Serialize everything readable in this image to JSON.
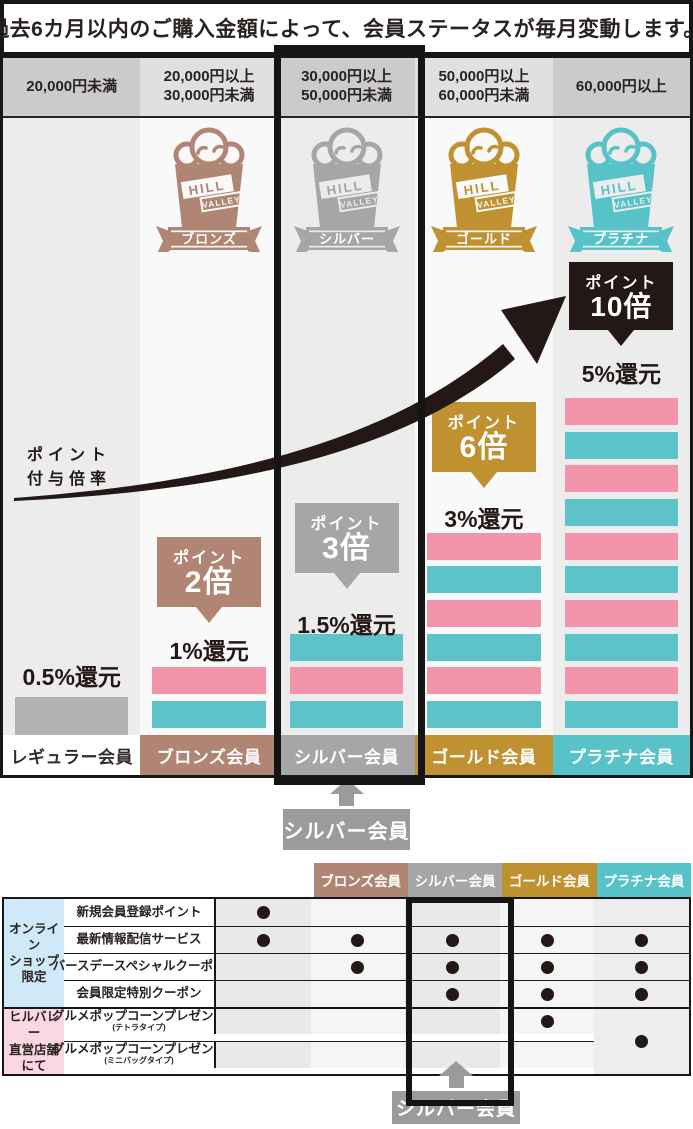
{
  "title": "過去6カ月以内のご購入金額によって、会員ステータスが毎月変動します。",
  "axis_label": {
    "line1": "ポイント",
    "line2": "付与倍率"
  },
  "brand": {
    "line1": "HILL",
    "line2": "VALLEY"
  },
  "pointer_callout": "シルバー会員",
  "colors": {
    "ink": "#231815",
    "frame": "#161616",
    "bronze": "#b08573",
    "silver": "#a6a6a8",
    "gold": "#bf9130",
    "platinum": "#57c3c8",
    "black_bubble": "#231815",
    "bar_pink": "#f295ab",
    "bar_teal": "#5cc3c8",
    "bar_gray": "#b1b1b1",
    "col_bg_dark": "#ececec",
    "col_bg_light": "#f9f9f9",
    "tier_bg_dark": "#cbcbcb",
    "tier_bg_light": "#e0e0e0",
    "pointer_gray": "#9b9b9b",
    "cat_blue": "#cfe9f8",
    "cat_pink": "#fbd7e2",
    "stripe_dark": "#e9e9e9",
    "stripe_light": "#f5f5f5"
  },
  "tiers": [
    {
      "id": "regular",
      "range_lines": [
        "20,000円未満"
      ],
      "badge_label": null,
      "bubble": null,
      "kangen": "0.5%還元",
      "bars": [
        "gray"
      ],
      "member_label": "レギュラー会員",
      "highlight": false
    },
    {
      "id": "bronze",
      "range_lines": [
        "20,000円以上",
        "30,000円未満"
      ],
      "badge_label": "ブロンズ",
      "bubble": {
        "prefix": "ポイント",
        "value": "2倍"
      },
      "kangen": "1%還元",
      "bars": [
        "pink",
        "teal"
      ],
      "member_label": "ブロンズ会員",
      "highlight": false
    },
    {
      "id": "silver",
      "range_lines": [
        "30,000円以上",
        "50,000円未満"
      ],
      "badge_label": "シルバー",
      "bubble": {
        "prefix": "ポイント",
        "value": "3倍"
      },
      "kangen": "1.5%還元",
      "bars": [
        "teal",
        "pink",
        "teal"
      ],
      "member_label": "シルバー会員",
      "highlight": true
    },
    {
      "id": "gold",
      "range_lines": [
        "50,000円以上",
        "60,000円未満"
      ],
      "badge_label": "ゴールド",
      "bubble": {
        "prefix": "ポイント",
        "value": "6倍"
      },
      "kangen": "3%還元",
      "bars": [
        "pink",
        "teal",
        "pink",
        "teal",
        "pink",
        "teal"
      ],
      "member_label": "ゴールド会員",
      "highlight": false
    },
    {
      "id": "platinum",
      "range_lines": [
        "60,000円以上"
      ],
      "badge_label": "プラチナ",
      "bubble": {
        "prefix": "ポイント",
        "value": "10倍"
      },
      "kangen": "5%還元",
      "bars": [
        "pink",
        "teal",
        "pink",
        "teal",
        "pink",
        "teal",
        "pink",
        "teal",
        "pink",
        "teal"
      ],
      "member_label": "プラチナ会員",
      "highlight": false
    }
  ],
  "benefits_table": {
    "column_headers": [
      "レギュラー会員",
      "ブロンズ会員",
      "シルバー会員",
      "ゴールド会員",
      "プラチナ会員"
    ],
    "highlight_column": "シルバー会員",
    "categories": [
      {
        "label_lines": [
          "オンライン",
          "ショップ",
          "限定"
        ],
        "color_key": "cat_blue",
        "rows": [
          {
            "label": "新規会員登録ポイント",
            "sub": null,
            "dots": [
              1,
              0,
              0,
              0,
              0
            ]
          },
          {
            "label": "最新情報配信サービス",
            "sub": null,
            "dots": [
              1,
              1,
              1,
              1,
              1
            ]
          },
          {
            "label": "バースデースペシャルクーポン",
            "sub": null,
            "dots": [
              0,
              1,
              1,
              1,
              1
            ]
          },
          {
            "label": "会員限定特別クーポン",
            "sub": null,
            "dots": [
              0,
              0,
              1,
              1,
              1
            ]
          }
        ]
      },
      {
        "label_lines": [
          "ヒルバレー",
          "直営店舗",
          "にて"
        ],
        "color_key": "cat_pink",
        "rows": [
          {
            "label": "グルメポップコーンプレゼント",
            "sub": "(テトラタイプ)",
            "dots": [
              0,
              0,
              0,
              1,
              0
            ]
          },
          {
            "label": "グルメポップコーンプレゼント",
            "sub": "(ミニバッグタイプ)",
            "dots": [
              0,
              0,
              0,
              0,
              0
            ]
          }
        ],
        "merged_cell": {
          "column_index": 4,
          "row_span": 2,
          "dot": 1
        }
      }
    ]
  }
}
